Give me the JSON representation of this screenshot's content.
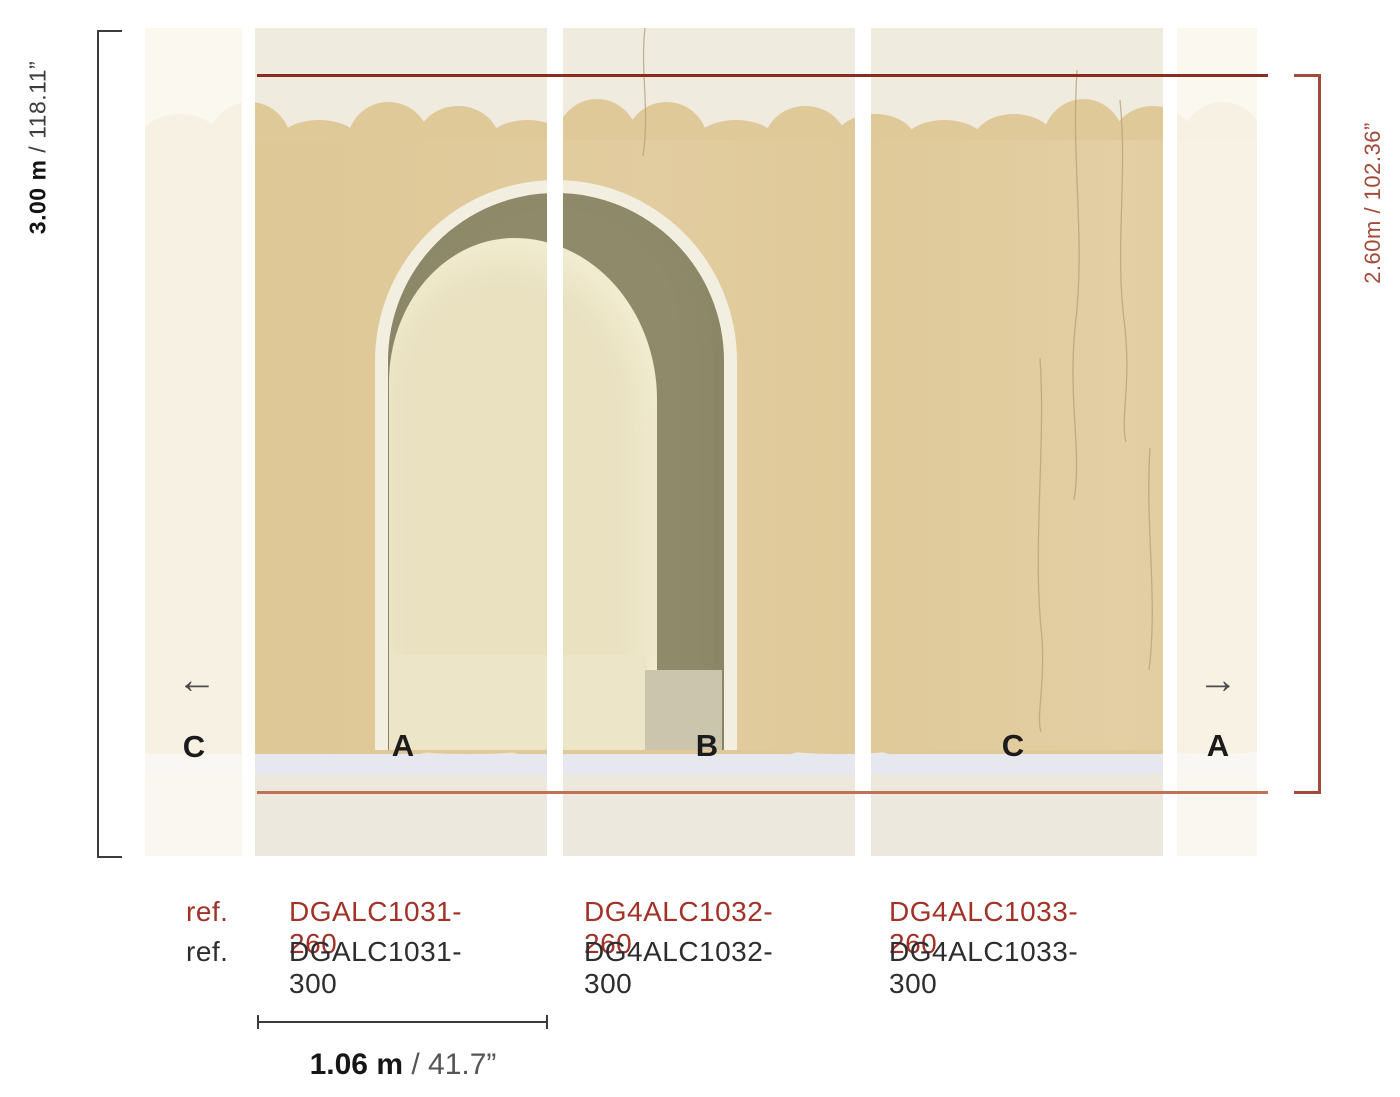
{
  "dimensions": {
    "height_full_metric": "3.00 m",
    "height_full_imperial": " / 118.11”",
    "height_260": "2.60m / 102.36”",
    "width_panel_metric": "1.06 m",
    "width_panel_imperial": " / 41.7”"
  },
  "panel_labels": {
    "strip_left": "C",
    "panel_a": "A",
    "panel_b": "B",
    "panel_c": "C",
    "strip_right": "A"
  },
  "icons": {
    "arrow_left": "←",
    "arrow_right": "→"
  },
  "refs": {
    "rows": [
      {
        "prefix": "ref.",
        "codes": [
          "DGALC1031-260",
          "DG4ALC1032-260",
          "DG4ALC1033-260"
        ]
      },
      {
        "prefix": "ref.",
        "codes": [
          "DGALC1031-300",
          "DG4ALC1032-300",
          "DG4ALC1033-300"
        ]
      }
    ]
  },
  "colors": {
    "plaster_top": "#f0ebdf",
    "wall_tan": "#dfc999",
    "arch_trim": "#f3efe0",
    "arch_shadow_olive": "#8f8a6a",
    "arch_interior_cream": "#e9e1c0",
    "arch_base_cream": "#ece5c7",
    "arch_base_gray": "#cbc5ae",
    "ground_edge": "#e7e8ef",
    "ground": "#ece8dd",
    "line_top_red": "#8c2b20",
    "line_bottom_red": "#c07257",
    "bracket_red": "#a24b3a",
    "bracket_black": "#3b3b3b",
    "ref_red": "#a23227",
    "text_dark": "#2d2d2d"
  }
}
